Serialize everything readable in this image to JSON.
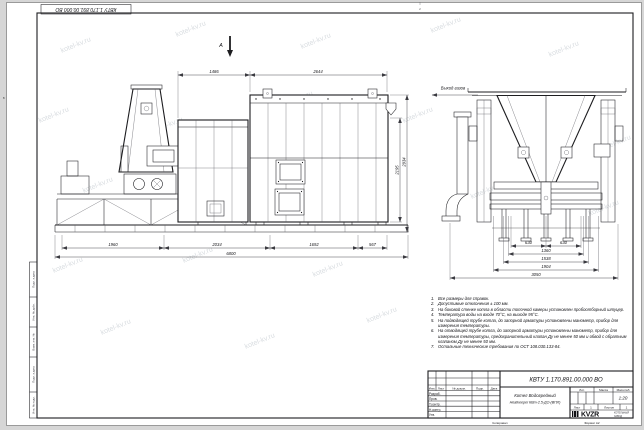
{
  "watermark": {
    "text": "kotel-kv.ru"
  },
  "frame": {
    "stamp_top_left": "КВТУ 1.170.891.00.000 ВО",
    "zone_top": "2",
    "zone_left": "В",
    "copied": "Копировал",
    "format": "Формат А2",
    "margin_cells": [
      "Подп. и дата",
      "Инв. № дубл.",
      "Взам. инв. №",
      "Подп. и дата",
      "Инв. № подл."
    ]
  },
  "views": {
    "direction_label": "А",
    "gas_outlet": "Выход газов",
    "dims": {
      "top": [
        "1486",
        "2644"
      ],
      "bottom": [
        "1960",
        "2034",
        "1692",
        "567"
      ],
      "total": "6800",
      "right_inner": "2195",
      "right_outer": "2934",
      "end_row1a": "630",
      "end_row1b": "630",
      "end_row2": "1360",
      "end_row3": "1538",
      "end_row4": "1904",
      "end_row5": "3050"
    }
  },
  "notes": {
    "items": [
      {
        "n": "1.",
        "text": "Все размеры для справок."
      },
      {
        "n": "2.",
        "text": "Допустимые отклонения ± 100 мм."
      },
      {
        "n": "3.",
        "text": "На боковой стенке котла в области топочной камеры установлен пробоотборный штуцер."
      },
      {
        "n": "4.",
        "text": "Температура воды на входе 70°С, на выходе 95°С."
      },
      {
        "n": "5.",
        "text": "На подводящей трубе котла, до запорной арматуры установлены манометр, прибор для измерения температуры."
      },
      {
        "n": "6.",
        "text": "На отводящей трубе котла, до запорной арматуры установлены манометр, прибор для измерения температуры, предохранительный клапан Ду не менее 50 мм и обвод с обратным клапаном Ду не менее 50 мм."
      },
      {
        "n": "7.",
        "text": "Остальные технические требования по ОСТ 108.030.133-84."
      }
    ]
  },
  "title_block": {
    "designation": "КВТУ 1.170.891.00.000 ВО",
    "name_line1": "Котел Водогрейный",
    "name_line2": "Heatkeeper КВт-2.5-ДО-(ВПЛ)",
    "col_izm": "Изм.",
    "col_list": "Лист",
    "col_doc": "№ докум.",
    "col_sign": "Подп.",
    "col_date": "Дата",
    "row_dev": "Разраб.",
    "row_check": "Пров.",
    "row_tcontr": "Т.контр.",
    "row_ncontr": "Н.контр.",
    "row_approve": "Утв.",
    "lit_label": "Лит.",
    "mass_label": "Масса",
    "scale_label": "Масштаб",
    "scale_value": "1:20",
    "sheet_label": "Лист",
    "sheet_value": "1",
    "sheets_label": "Листов",
    "sheets_value": "1",
    "logo_text": "KVZR",
    "logo_sub1": "КОТЕЛЬНЫЙ",
    "logo_sub2": "ЗАВОД"
  }
}
